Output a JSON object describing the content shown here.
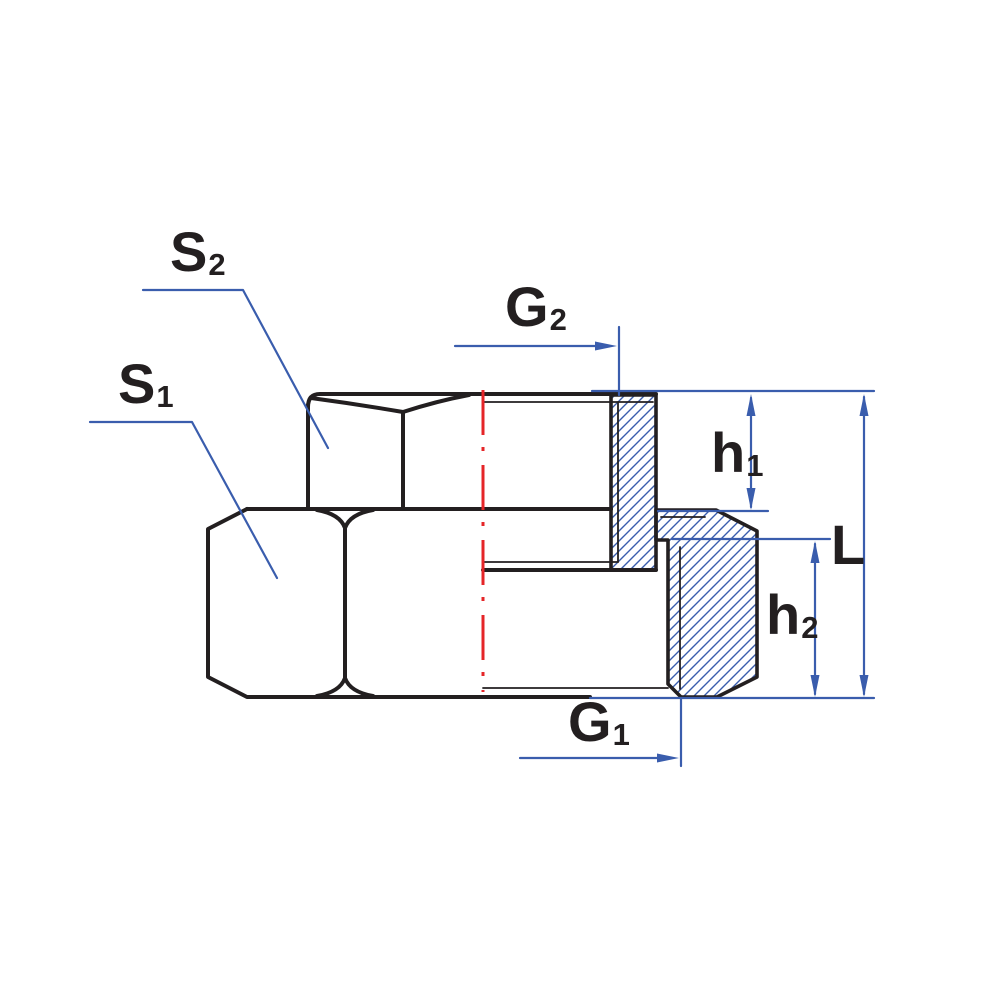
{
  "title": "reducing-socket-dimension-drawing",
  "labels": {
    "s2": {
      "main": "S",
      "sub": "2"
    },
    "s1": {
      "main": "S",
      "sub": "1"
    },
    "g2": {
      "main": "G",
      "sub": "2"
    },
    "g1": {
      "main": "G",
      "sub": "1"
    },
    "h1": {
      "main": "h",
      "sub": "1"
    },
    "h2": {
      "main": "h",
      "sub": "2"
    },
    "l": {
      "main": "L",
      "sub": ""
    }
  },
  "colors": {
    "outline": "#231f20",
    "dimension": "#3a5dad",
    "hatch": "#3a5dad",
    "centerline": "#e52528",
    "background": "#ffffff"
  }
}
